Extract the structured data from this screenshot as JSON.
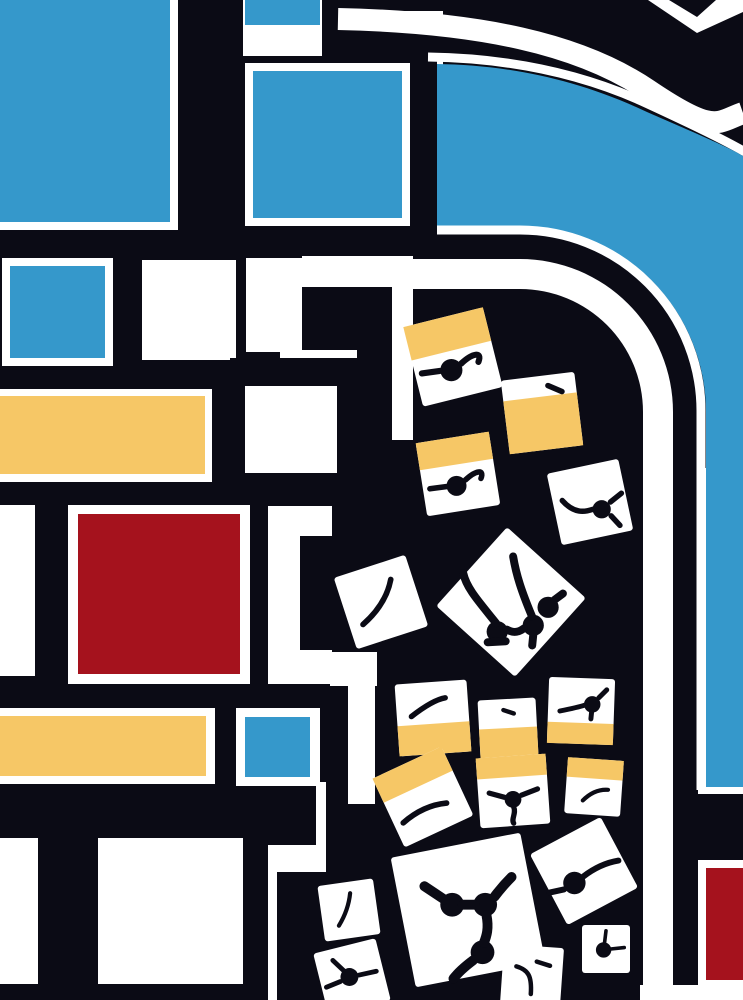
{
  "canvas": {
    "width": 743,
    "height": 1000
  },
  "colors": {
    "black": "#0b0b15",
    "white": "#ffffff",
    "blue": "#3598cb",
    "yellow": "#f6c766",
    "red": "#a5121d"
  },
  "shapes": [
    {
      "n": "base-black-field",
      "t": "rect",
      "x": 0,
      "y": 0,
      "w": 743,
      "h": 1000,
      "f": "black"
    },
    {
      "n": "top-left-white-frame",
      "t": "rect",
      "x": 0,
      "y": 0,
      "w": 178,
      "h": 230,
      "f": "white"
    },
    {
      "n": "top-left-blue-block",
      "t": "rect",
      "x": 0,
      "y": 0,
      "w": 170,
      "h": 222,
      "f": "blue"
    },
    {
      "n": "top-mid-white-bg",
      "t": "rect",
      "x": 243,
      "y": 0,
      "w": 200,
      "h": 230,
      "f": "white"
    },
    {
      "n": "top-small-blue-block",
      "t": "rect",
      "x": 245,
      "y": 0,
      "w": 75,
      "h": 25,
      "f": "blue"
    },
    {
      "n": "top-black-bar",
      "t": "rect",
      "x": 322,
      "y": 0,
      "w": 26,
      "h": 113,
      "f": "black"
    },
    {
      "n": "top-black-strip",
      "t": "rect",
      "x": 336,
      "y": 0,
      "w": 107,
      "h": 11,
      "f": "black"
    },
    {
      "n": "top-black-band",
      "t": "rect",
      "x": 345,
      "y": 28,
      "w": 98,
      "h": 30,
      "f": "black"
    },
    {
      "n": "framed-blue-black-frame",
      "t": "rect",
      "x": 238,
      "y": 56,
      "w": 199,
      "h": 176,
      "f": "black"
    },
    {
      "n": "framed-blue-bar-top",
      "t": "rect",
      "x": 410,
      "y": 24,
      "w": 27,
      "h": 36,
      "f": "black"
    },
    {
      "n": "framed-blue-white-ring",
      "t": "rect",
      "x": 245,
      "y": 63,
      "w": 165,
      "h": 163,
      "f": "white"
    },
    {
      "n": "framed-blue-block",
      "t": "rect",
      "x": 253,
      "y": 71,
      "w": 149,
      "h": 147,
      "f": "blue"
    },
    {
      "n": "rowb-white-frame-1",
      "t": "rect",
      "x": 2,
      "y": 258,
      "w": 111,
      "h": 108,
      "f": "white"
    },
    {
      "n": "rowb-blue-block",
      "t": "rect",
      "x": 10,
      "y": 266,
      "w": 95,
      "h": 92,
      "f": "blue"
    },
    {
      "n": "rowb-white-square-2",
      "t": "rect",
      "x": 142,
      "y": 260,
      "w": 94,
      "h": 100,
      "f": "white"
    },
    {
      "n": "rowb-white-square-3",
      "t": "rect",
      "x": 270,
      "y": 258,
      "w": 62,
      "h": 74,
      "f": "white"
    },
    {
      "n": "maze-white-col-left",
      "t": "rect",
      "x": 246,
      "y": 258,
      "w": 56,
      "h": 94,
      "f": "white"
    },
    {
      "n": "maze-white-stripe-tail",
      "t": "rect",
      "x": 302,
      "y": 256,
      "w": 111,
      "h": 33,
      "f": "white"
    },
    {
      "n": "maze-white-col-right",
      "t": "rect",
      "x": 392,
      "y": 256,
      "w": 21,
      "h": 184,
      "f": "white"
    },
    {
      "n": "maze-black-block",
      "t": "rect",
      "x": 302,
      "y": 287,
      "w": 90,
      "h": 63,
      "f": "black"
    },
    {
      "n": "maze-white-slot-1",
      "t": "rect",
      "x": 280,
      "y": 350,
      "w": 77,
      "h": 9,
      "f": "white"
    },
    {
      "n": "maze-black-arm",
      "t": "rect",
      "x": 357,
      "y": 350,
      "w": 35,
      "h": 122,
      "f": "black"
    },
    {
      "n": "maze-black-square-frame",
      "t": "rect",
      "x": 230,
      "y": 358,
      "w": 133,
      "h": 132,
      "f": "black"
    },
    {
      "n": "maze-white-square",
      "t": "rect",
      "x": 245,
      "y": 386,
      "w": 92,
      "h": 87,
      "f": "white"
    },
    {
      "n": "yellow-row-white-frame",
      "t": "rect",
      "x": 0,
      "y": 389,
      "w": 212,
      "h": 93,
      "f": "white"
    },
    {
      "n": "yellow-row-block",
      "t": "rect",
      "x": 0,
      "y": 396,
      "w": 205,
      "h": 78,
      "f": "yellow"
    },
    {
      "n": "red-row-white-strip",
      "t": "rect",
      "x": 0,
      "y": 505,
      "w": 35,
      "h": 171,
      "f": "white"
    },
    {
      "n": "red-block-white-frame",
      "t": "rect",
      "x": 68,
      "y": 505,
      "w": 182,
      "h": 179,
      "f": "white"
    },
    {
      "n": "red-block",
      "t": "rect",
      "x": 78,
      "y": 514,
      "w": 162,
      "h": 160,
      "f": "red"
    },
    {
      "n": "maze-white-col-mid",
      "t": "rect",
      "x": 268,
      "y": 506,
      "w": 64,
      "h": 178,
      "f": "white"
    },
    {
      "n": "maze-black-notch",
      "t": "rect",
      "x": 300,
      "y": 536,
      "w": 32,
      "h": 114,
      "f": "black"
    },
    {
      "n": "yellow-row2-white-frame",
      "t": "rect",
      "x": 0,
      "y": 708,
      "w": 215,
      "h": 76,
      "f": "white"
    },
    {
      "n": "yellow-row2-block",
      "t": "rect",
      "x": 0,
      "y": 716,
      "w": 206,
      "h": 60,
      "f": "yellow"
    },
    {
      "n": "small-blue-white-frame",
      "t": "rect",
      "x": 236,
      "y": 708,
      "w": 84,
      "h": 78,
      "f": "white"
    },
    {
      "n": "small-blue-block",
      "t": "rect",
      "x": 245,
      "y": 717,
      "w": 65,
      "h": 60,
      "f": "blue"
    },
    {
      "n": "bottom-white-strip-1",
      "t": "rect",
      "x": 0,
      "y": 838,
      "w": 38,
      "h": 146,
      "f": "white"
    },
    {
      "n": "bottom-white-square-2",
      "t": "rect",
      "x": 98,
      "y": 838,
      "w": 145,
      "h": 146,
      "f": "white"
    },
    {
      "n": "meander-slot-a",
      "t": "rect",
      "x": 330,
      "y": 652,
      "w": 47,
      "h": 34,
      "f": "white"
    },
    {
      "n": "meander-vert-a",
      "t": "rect",
      "x": 348,
      "y": 686,
      "w": 27,
      "h": 118,
      "f": "white"
    },
    {
      "n": "meander-vert-b",
      "t": "rect",
      "x": 316,
      "y": 782,
      "w": 10,
      "h": 63,
      "f": "white"
    },
    {
      "n": "meander-slot-b",
      "t": "rect",
      "x": 277,
      "y": 845,
      "w": 49,
      "h": 27,
      "f": "white"
    },
    {
      "n": "meander-vert-c",
      "t": "rect",
      "x": 268,
      "y": 845,
      "w": 9,
      "h": 155,
      "f": "white"
    },
    {
      "n": "road-white-stripe",
      "t": "path",
      "d": "M413,259 L520,259 A153,153 0 0 1 673,412 L673,1000 L643,1000 L643,412 A123,123 0 0 0 520,289 L413,289 Z",
      "f": "white"
    },
    {
      "n": "blue-band-white-frame",
      "t": "rect",
      "x": 698,
      "y": 468,
      "w": 45,
      "h": 326,
      "f": "white"
    },
    {
      "n": "curve-outer-white-border",
      "t": "path",
      "d": "M428,57 C500,58 575,70 648,104 C700,128 728,142 745,152",
      "s": "white",
      "sw": 9
    },
    {
      "n": "blue-curve-field",
      "t": "path",
      "d": "M437,64 C505,65 575,78 647,112 C700,135 730,148 743,156 L743,787 L706,787 L706,412 A186,186 0 0 0 520,226 L437,226 Z",
      "f": "blue"
    },
    {
      "n": "curve-inner-white-border",
      "t": "path",
      "d": "M437,230 L520,230 A181,181 0 0 1 701,412 L701,790",
      "s": "white",
      "sw": 9
    },
    {
      "n": "corner-white-stripe",
      "t": "path",
      "d": "M338,19 C480,22 580,44 648,90 S717,122 743,113",
      "s": "white",
      "sw": 22
    },
    {
      "n": "corner-white-chevron",
      "t": "path",
      "d": "M648,0 L697,33 L743,12 L743,0 L716,0 L697,17 L669,0 Z",
      "f": "white"
    },
    {
      "n": "right-red-white-frame",
      "t": "rect",
      "x": 698,
      "y": 860,
      "w": 45,
      "h": 128,
      "f": "white"
    },
    {
      "n": "right-red-block",
      "t": "rect",
      "x": 706,
      "y": 868,
      "w": 37,
      "h": 112,
      "f": "red"
    },
    {
      "n": "bottom-right-white-strip",
      "t": "rect",
      "x": 640,
      "y": 985,
      "w": 103,
      "h": 15,
      "f": "white"
    }
  ],
  "tiles": [
    {
      "n": "tile-1",
      "cx": 453,
      "cy": 357,
      "s": 82,
      "rot": -14,
      "band": "t0.42",
      "motif": "node"
    },
    {
      "n": "tile-2",
      "cx": 542,
      "cy": 413,
      "s": 74,
      "rot": -7,
      "band": "b0.72",
      "motif": "tick"
    },
    {
      "n": "tile-3",
      "cx": 458,
      "cy": 474,
      "s": 74,
      "rot": -9,
      "band": "t0.37",
      "motif": "node"
    },
    {
      "n": "tile-4",
      "cx": 590,
      "cy": 502,
      "s": 73,
      "rot": -12,
      "band": null,
      "motif": "whisker2"
    },
    {
      "n": "tile-5",
      "cx": 381,
      "cy": 602,
      "s": 75,
      "rot": -18,
      "band": null,
      "motif": "arc"
    },
    {
      "n": "tile-6",
      "cx": 511,
      "cy": 602,
      "s": 106,
      "rot": 42,
      "band": null,
      "motif": "sprout3"
    },
    {
      "n": "tile-7",
      "cx": 433,
      "cy": 718,
      "s": 72,
      "rot": -4,
      "band": "b0.42",
      "motif": "arc7"
    },
    {
      "n": "tile-8",
      "cx": 508,
      "cy": 728,
      "s": 58,
      "rot": -3,
      "band": "b0.5",
      "motif": "tick2"
    },
    {
      "n": "tile-9",
      "cx": 581,
      "cy": 711,
      "s": 66,
      "rot": 2,
      "band": "b0.32",
      "motif": "nodeup"
    },
    {
      "n": "tile-10",
      "cx": 423,
      "cy": 797,
      "s": 76,
      "rot": -25,
      "band": "t0.35",
      "motif": "arcA"
    },
    {
      "n": "tile-11",
      "cx": 513,
      "cy": 791,
      "s": 70,
      "rot": -4,
      "band": "t0.30",
      "motif": "node3"
    },
    {
      "n": "tile-12",
      "cx": 594,
      "cy": 787,
      "s": 56,
      "rot": 4,
      "band": "t0.35",
      "motif": "arcC"
    },
    {
      "n": "tile-13",
      "cx": 584,
      "cy": 871,
      "s": 80,
      "rot": -28,
      "band": null,
      "motif": "dotcurve"
    },
    {
      "n": "tile-14",
      "cx": 468,
      "cy": 910,
      "s": 132,
      "rot": -11,
      "band": null,
      "motif": "net3"
    },
    {
      "n": "tile-15",
      "cx": 349,
      "cy": 910,
      "s": 56,
      "rot": -8,
      "band": null,
      "motif": "arcF"
    },
    {
      "n": "tile-16",
      "cx": 352,
      "cy": 977,
      "s": 64,
      "rot": -14,
      "band": null,
      "motif": "node3g"
    },
    {
      "n": "tile-17",
      "cx": 532,
      "cy": 976,
      "s": 60,
      "rot": 4,
      "band": null,
      "motif": "curve7"
    },
    {
      "n": "tile-18",
      "cx": 606,
      "cy": 949,
      "s": 48,
      "rot": 0,
      "band": null,
      "motif": "dotline"
    }
  ],
  "motifs": {
    "node": {
      "c": [
        [
          -0.02,
          0.16,
          0.135
        ]
      ],
      "p": [
        "M-0.38,0.2 L-0.16,0.17",
        "M0.1,0.08 C0.24,-0.05 0.36,-0.07 0.31,0.06"
      ]
    },
    "tick": {
      "c": [],
      "p": [
        "M0.08,-0.37 L0.27,-0.29"
      ]
    },
    "tick2": {
      "c": [],
      "p": [
        "M-0.08,-0.31 L0.1,-0.25"
      ]
    },
    "whisker2": {
      "c": [
        [
          0.16,
          0.1,
          0.125
        ]
      ],
      "p": [
        "M-0.38,-0.02 C-0.22,0.16 -0.08,0.14 0.04,0.1",
        "M0.28,0 L0.43,-0.12",
        "M0.29,0.19 L0.41,0.32"
      ]
    },
    "arc": {
      "c": [],
      "p": [
        "M-0.24,0.3 C-0.08,0.16 0.08,-0.04 0.13,-0.3"
      ]
    },
    "sprout3": {
      "c": [
        [
          -0.13,
          0.28,
          0.1
        ],
        [
          0.21,
          0.22,
          0.1
        ],
        [
          0.35,
          0.05,
          0.1
        ]
      ],
      "p": [
        "M-0.14,0.2 C-0.3,0 -0.42,-0.13 -0.45,-0.27",
        "M0.2,0.14 C0.1,-0.1 0.05,-0.25 0.02,-0.43",
        "M0.41,-0.02 L0.49,-0.08",
        "M-0.04,0.26 C0.03,0.3 0.08,0.28 0.12,0.25",
        "M-0.22,0.38 L-0.05,0.37",
        "M0.21,0.31 L0.2,0.41"
      ]
    },
    "arc7": {
      "c": [],
      "p": [
        "M-0.3,-0.02 C-0.12,-0.16 0.05,-0.26 0.17,-0.28"
      ]
    },
    "nodeup": {
      "c": [
        [
          0.17,
          -0.1,
          0.125
        ]
      ],
      "p": [
        "M-0.32,0 C-0.12,-0.04 0,-0.07 0.06,-0.09",
        "M0.27,-0.2 L0.39,-0.32",
        "M0.16,0.02 L0.15,0.12"
      ]
    },
    "arcA": {
      "c": [],
      "p": [
        "M-0.26,0.34 C-0.1,0.2 0.1,0.1 0.31,0.08"
      ]
    },
    "node3": {
      "c": [
        [
          0,
          0.12,
          0.12
        ]
      ],
      "p": [
        "M-0.34,0.03 L-0.12,0.09",
        "M0.12,0.06 L0.35,-0.03",
        "M0.01,0.23 C0.05,0.32 -0.03,0.4 0.01,0.46"
      ]
    },
    "arcC": {
      "c": [],
      "p": [
        "M-0.2,0.24 C-0.06,0.1 0.1,0.04 0.25,0.05"
      ]
    },
    "dotcurve": {
      "c": [
        [
          -0.12,
          0.15,
          0.14
        ]
      ],
      "p": [
        "M-0.01,0.07 C0.16,-0.06 0.31,-0.11 0.43,-0.13",
        "M-0.43,0.27 L-0.25,0.23"
      ]
    },
    "net3": {
      "c": [
        [
          -0.12,
          -0.04,
          0.09
        ],
        [
          0.13,
          -0.04,
          0.09
        ],
        [
          0.11,
          0.32,
          0.09
        ]
      ],
      "p": [
        "M-0.18,-0.08 L-0.33,-0.18",
        "M-0.04,-0.04 L0.05,-0.04",
        "M0.2,-0.1 C0.26,-0.18 0.3,-0.22 0.33,-0.25",
        "M0.14,0.04 C0.16,0.14 0.14,0.2 0.12,0.25",
        "M0.04,0.38 C-0.04,0.44 -0.08,0.48 -0.11,0.52"
      ]
    },
    "arcF": {
      "c": [],
      "p": [
        "M-0.18,0.28 C-0.07,0.1 0,-0.1 0.02,-0.3"
      ]
    },
    "node3g": {
      "c": [
        [
          -0.04,
          0,
          0.14
        ]
      ],
      "p": [
        "M-0.4,0.16 L-0.18,0.07",
        "M0.11,-0.03 L0.38,-0.09",
        "M-0.13,-0.1 L-0.3,-0.26"
      ]
    },
    "curve7": {
      "c": [],
      "p": [
        "M-0.26,-0.16 C-0.06,-0.1 0,0 -0.02,0.3",
        "M0.08,-0.24 L0.3,-0.17"
      ]
    },
    "dotline": {
      "c": [
        [
          -0.05,
          0.02,
          0.16
        ]
      ],
      "p": [
        "M0.1,0 L0.38,-0.03",
        "M-0.03,-0.13 L0,-0.38"
      ]
    }
  }
}
